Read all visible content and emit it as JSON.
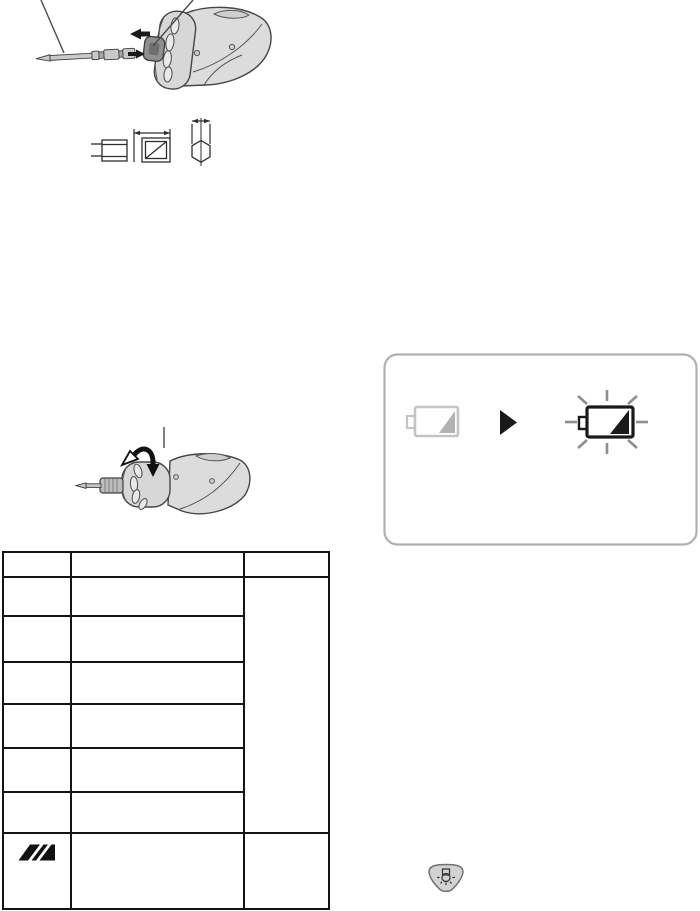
{
  "page": {
    "kind": "operating-instructions-page",
    "visible_text": "",
    "colors": {
      "page_bg": "#ffffff",
      "line_art_outline": "#454545",
      "line_art_fill_light": "#dcdcdc",
      "line_art_fill_mid": "#c9c9c9",
      "line_art_fill_dark": "#8f8f8f",
      "table_border": "#141414",
      "panel_border": "#b0b0b0",
      "dim_gray": "#c4c4c4",
      "wedge_gray": "#b2b2b2",
      "ray_gray": "#8e8e8e",
      "solid_black": "#1a1a1a",
      "button_fill": "#d2d2d2"
    }
  },
  "figures": {
    "bit_insertion": {
      "description_icons": [
        "screwdriver-bit-icon",
        "arrow-left-icon",
        "arrow-right-icon",
        "tool-nose-icon",
        "callout-leader-line",
        "callout-leader-line"
      ]
    },
    "bit_dimensions": {
      "description_icons": [
        "bit-side-view-icon",
        "dimension-arrow-icon",
        "bit-hex-section-icon",
        "dimension-arrow-icon"
      ]
    },
    "collar_turn": {
      "description_icons": [
        "rotate-collar-arrow-icon",
        "tool-nose-with-bit-icon",
        "callout-leader-line"
      ]
    }
  },
  "battery_panel": {
    "icons": [
      {
        "name": "battery-low-dim-icon"
      },
      {
        "name": "play-arrow-icon"
      },
      {
        "name": "battery-low-blinking-icon"
      }
    ]
  },
  "table": {
    "header": [
      "",
      "",
      ""
    ],
    "rows": [
      [
        "",
        ""
      ],
      [
        "",
        ""
      ],
      [
        "",
        ""
      ],
      [
        "",
        ""
      ],
      [
        "",
        ""
      ],
      [
        "",
        ""
      ]
    ],
    "merged_cell": "",
    "last_row": {
      "icon": "display-blinking-icon",
      "label": "",
      "cell2": "",
      "cell3": ""
    }
  },
  "light_button": {
    "icon": "led-light-button-icon"
  }
}
